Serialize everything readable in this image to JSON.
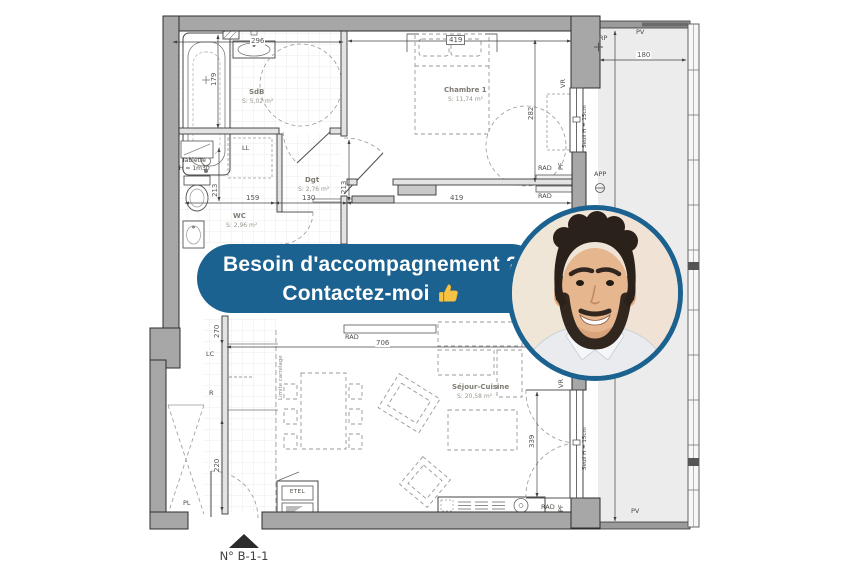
{
  "banner": {
    "line1": "Besoin d'accompagnement ?",
    "line2": "Contactez-moi",
    "bg_color": "#1c6290",
    "text_color": "#ffffff",
    "icon": "thumbs-up"
  },
  "photo": {
    "border_color": "#1c6290"
  },
  "plan": {
    "unit_label": "N° B-1-1",
    "rooms": {
      "sdb": {
        "name": "SdB",
        "area": "S: 5,02 m²"
      },
      "chambre": {
        "name": "Chambre 1",
        "area": "S: 11,74 m²"
      },
      "dgt": {
        "name": "Dgt",
        "area": "S: 2,76 m²"
      },
      "wc": {
        "name": "WC",
        "area": "S: 2,96 m²"
      },
      "sejour": {
        "name": "Séjour-Cuisine",
        "area": "S: 20,58 m²"
      }
    },
    "dims": {
      "d296": "296",
      "d419_top": "419",
      "d179": "179",
      "d282": "282",
      "d213_left": "213",
      "d213_mid": "213",
      "d159": "159",
      "d130": "130",
      "d419_bottom": "419",
      "d270": "270",
      "d220": "220",
      "d706": "706",
      "d339": "339",
      "d180": "180"
    },
    "labels": {
      "ll": "LL",
      "tablette1": "Tablette",
      "tablette2": "H = 1m30",
      "lc": "LC",
      "r": "R",
      "limite_carrelage": "Limite carrelage",
      "rad": "RAD",
      "vr": "VR",
      "pf": "PF",
      "seuil": "Seuil H = 15cm",
      "rp": "RP",
      "pv": "PV",
      "app": "APP",
      "pl": "PL",
      "etel": "ETEL"
    }
  }
}
